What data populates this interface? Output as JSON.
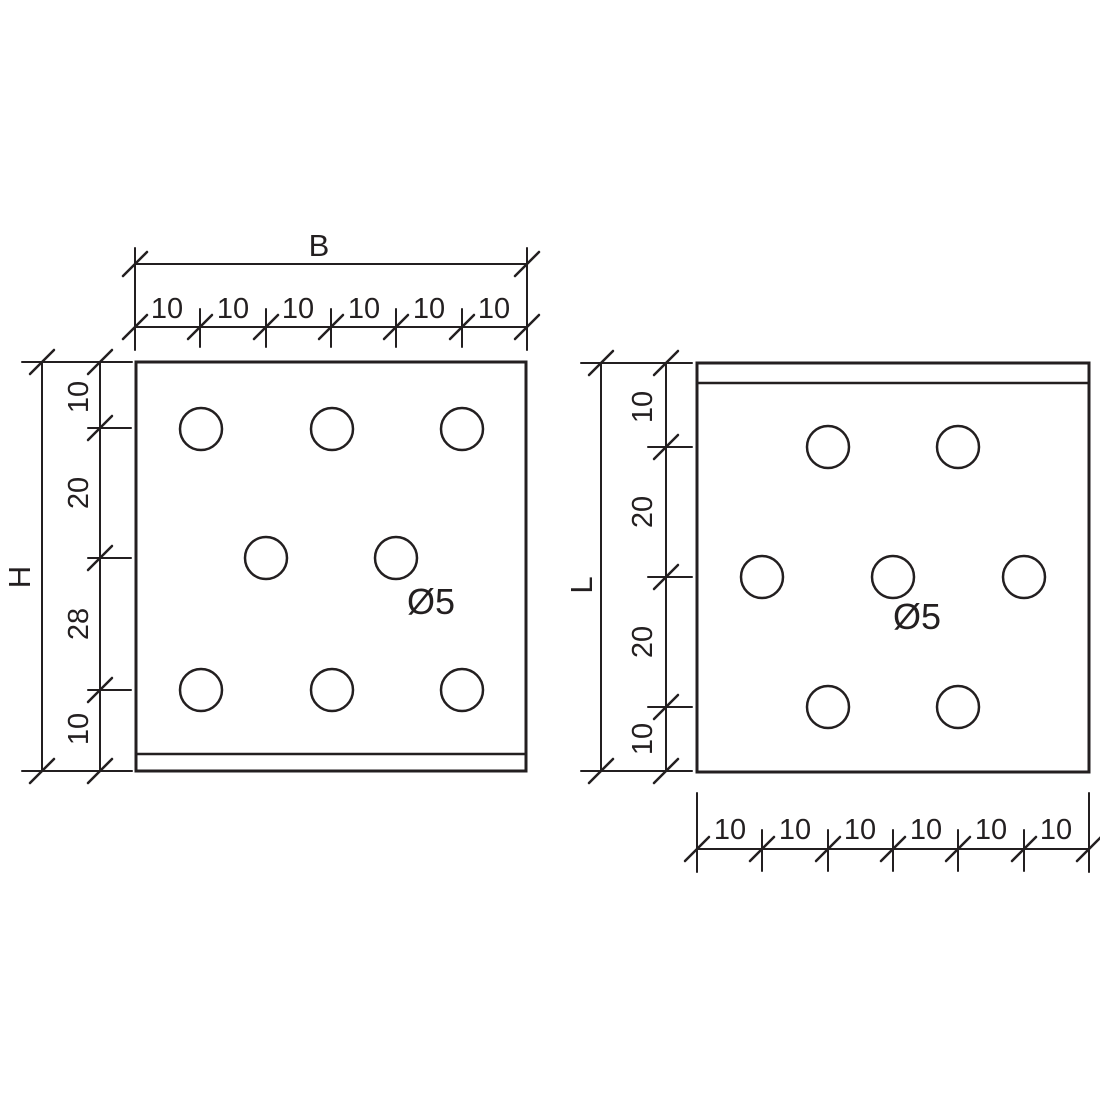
{
  "colors": {
    "line_color": "#231f20",
    "background": "#ffffff"
  },
  "left_view": {
    "width_dimension": {
      "label": "B",
      "segments": [
        "10",
        "10",
        "10",
        "10",
        "10",
        "10"
      ]
    },
    "height_dimension": {
      "label": "H",
      "segments": [
        "10",
        "20",
        "28",
        "10"
      ]
    },
    "hole_label": "Ø5"
  },
  "right_view": {
    "height_dimension": {
      "label": "L",
      "segments": [
        "10",
        "20",
        "20",
        "10"
      ]
    },
    "width_dimension": {
      "segments": [
        "10",
        "10",
        "10",
        "10",
        "10",
        "10"
      ]
    },
    "hole_label": "Ø5"
  }
}
